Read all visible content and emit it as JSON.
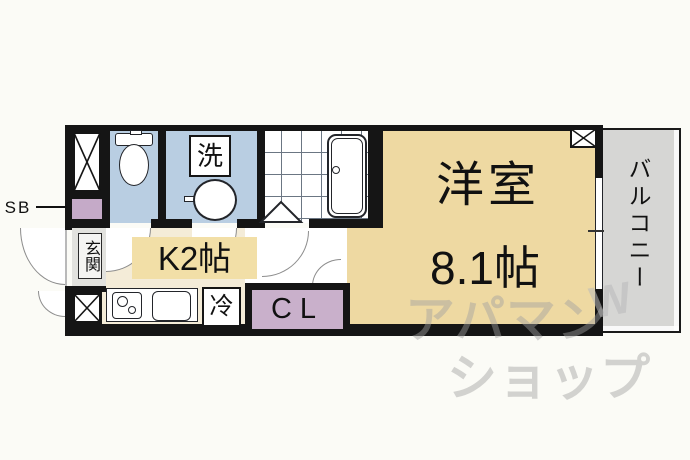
{
  "title": "apartment-floor-plan",
  "colors": {
    "wall": "#151515",
    "main_room_floor": "#eed9a2",
    "kitchen_floor": "#f4ecd8",
    "kitchen_label_bg": "#f2dfa7",
    "wet_area": "#b9cee2",
    "closet": "#c9b0cb",
    "shaft_box": "#c5aac8",
    "balcony": "#d6d6d4",
    "entrance_floor": "#e2e2de",
    "watermark": "#c8c8c8"
  },
  "rooms": {
    "main": {
      "name": "洋室",
      "size": "8.1帖"
    },
    "kitchen": {
      "label": "K2帖"
    },
    "balcony": {
      "label": "バルコニー"
    },
    "entrance": {
      "label": "玄関"
    },
    "closet": {
      "label": "CL"
    },
    "shaft": {
      "label": "SB"
    }
  },
  "fixtures": {
    "washer": {
      "label": "洗"
    },
    "fridge": {
      "label": "冷"
    }
  },
  "watermark": {
    "line1": "アパマン",
    "line2": "ショップ",
    "logo": "W"
  }
}
